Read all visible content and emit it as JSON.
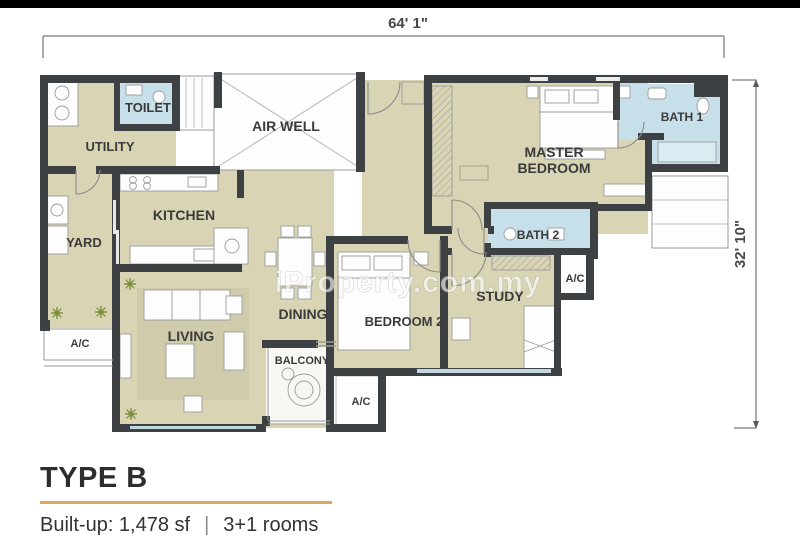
{
  "watermark": {
    "text": "iProperty.com.my"
  },
  "dimensions": {
    "width": "64' 1\"",
    "height": "32' 10\""
  },
  "rooms": {
    "toilet": "TOILET",
    "utility": "UTILITY",
    "air_well": "AIR WELL",
    "kitchen": "KITCHEN",
    "yard": "YARD",
    "living": "LIVING",
    "dining": "DINING",
    "balcony": "BALCONY",
    "bedroom2": "BEDROOM 2",
    "study": "STUDY",
    "master_line1": "MASTER",
    "master_line2": "BEDROOM",
    "bath1": "BATH 1",
    "bath2": "BATH 2",
    "ac": "A/C"
  },
  "caption": {
    "type": "TYPE B",
    "built_up": "Built-up: 1,478 sf",
    "separator": "|",
    "rooms": "3+1 rooms"
  },
  "colors": {
    "wall": "#3d4144",
    "floor": "#d9d5b4",
    "wet_area": "#c7dfe8",
    "accent_line": "#d9a85c",
    "label": "#3a3a3a"
  }
}
